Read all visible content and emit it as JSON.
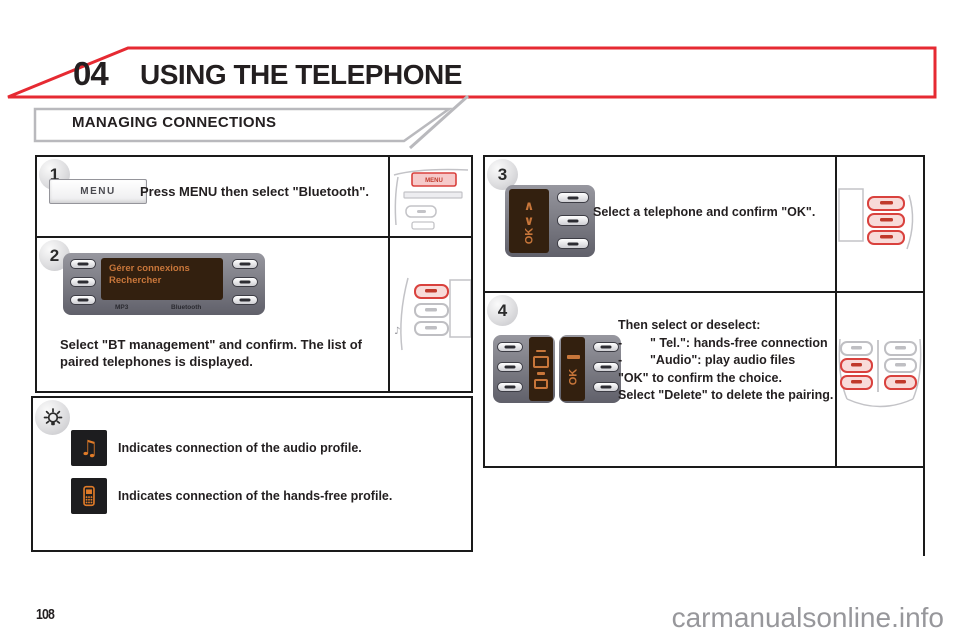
{
  "header": {
    "chapter_number": "04",
    "chapter_title": "USING THE TELEPHONE",
    "section_title": "MANAGING CONNECTIONS"
  },
  "colors": {
    "accent_red": "#e62a32",
    "thumbnail_red": "#d9413d",
    "screen_background": "#33200f",
    "screen_text_orange": "#c8763a",
    "icon_orange": "#e07b28"
  },
  "steps": {
    "s1": {
      "number": "1",
      "menu_button_label": "MENU",
      "thumb_menu_label": "MENU",
      "instruction": "Press MENU then select \"Bluetooth\"."
    },
    "s2": {
      "number": "2",
      "screen_line1": "Gérer connexions",
      "screen_line2": "Rechercher",
      "device_label_mp3": "MP3",
      "device_label_bluetooth": "Bluetooth",
      "instruction": "Select \"BT management\" and confirm. The list of paired telephones is displayed."
    },
    "s3": {
      "number": "3",
      "up_glyph": "∧",
      "down_glyph": "∨",
      "ok_label": "OK",
      "instruction": "Select a telephone and confirm \"OK\"."
    },
    "s4": {
      "number": "4",
      "intro": "Then select or deselect:",
      "bullet_dash": "-",
      "bullet1": "\" Tel.\": hands-free connection",
      "bullet2": "\"Audio\": play audio files",
      "line_ok": "\"OK\" to confirm the choice.",
      "line_delete": "Select \"Delete\" to delete the pairing.",
      "ok_label": "OK"
    }
  },
  "tip_box": {
    "music_icon_glyph": "♫",
    "audio_text": "Indicates connection of the audio profile.",
    "handsfree_text": "Indicates connection of the hands-free profile."
  },
  "thumbnails": {
    "note_glyph": "♪"
  },
  "footer": {
    "page_number": "108",
    "watermark": "carmanualsonline.info"
  }
}
